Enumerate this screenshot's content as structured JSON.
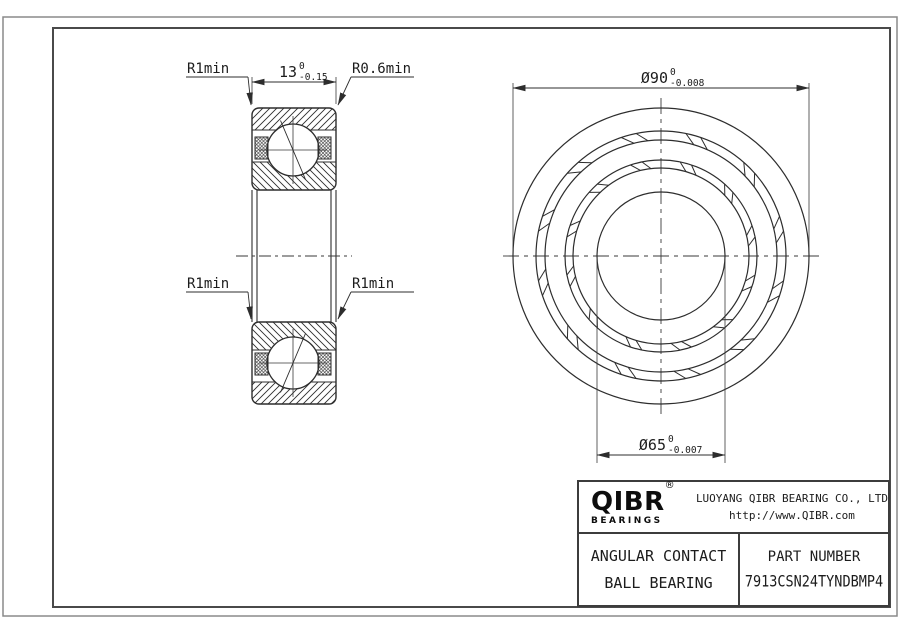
{
  "drawing": {
    "type": "angular contact ball bearing engineering drawing",
    "line_color": "#2d2d2d",
    "background": "#ffffff"
  },
  "dims": {
    "width": {
      "value": "13",
      "tol_upper": "0",
      "tol_lower": "-0.15"
    },
    "outer_diameter": {
      "value": "Ø90",
      "tol_upper": "0",
      "tol_lower": "-0.008"
    },
    "bore_diameter": {
      "value": "Ø65",
      "tol_upper": "0",
      "tol_lower": "-0.007"
    }
  },
  "labels": {
    "top_left_radius": "R1min",
    "top_right_radius": "R0.6min",
    "mid_left_radius": "R1min",
    "mid_right_radius": "R1min"
  },
  "title_block": {
    "logo": {
      "name": "QIBR",
      "registered": "®",
      "subtitle": "BEARINGS"
    },
    "company": "LUOYANG QIBR BEARING CO., LTD",
    "website": "http://www.QIBR.com",
    "product_line1": "ANGULAR CONTACT",
    "product_line2": "BALL BEARING",
    "part_number_label": "PART NUMBER",
    "part_number": "7913CSN24TYNDBMP4"
  }
}
